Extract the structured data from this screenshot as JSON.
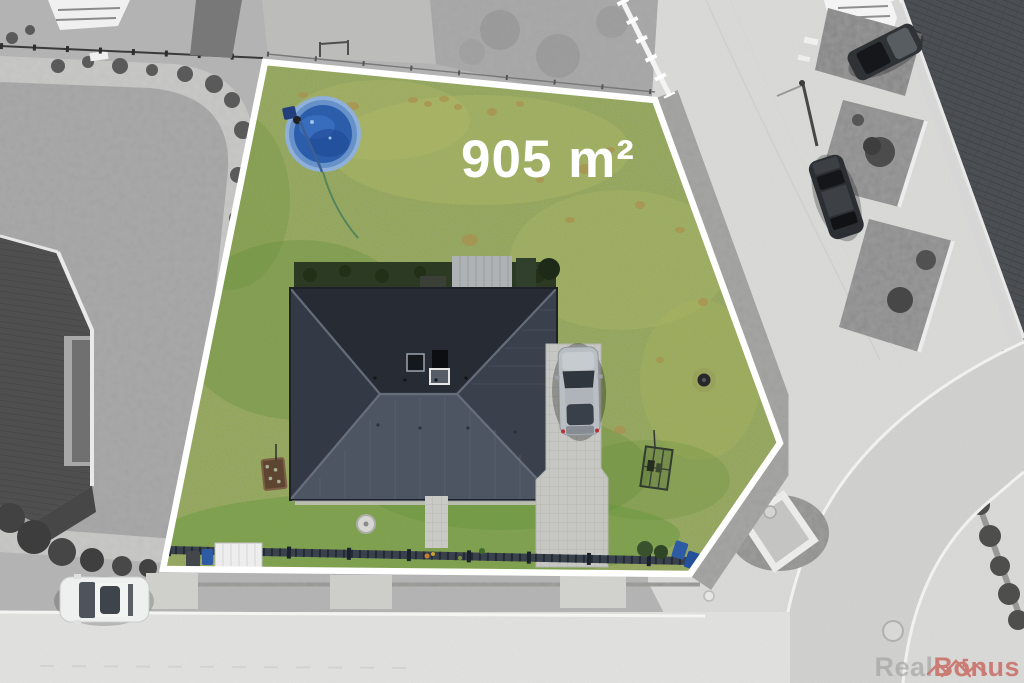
{
  "plot": {
    "area_label": "905 m²",
    "boundary_color": "#ffffff"
  },
  "watermark": {
    "brand_first": "Real",
    "brand_second": "Bonus",
    "first_color": "#9b9b9b",
    "second_color": "#c23a2e"
  },
  "colors": {
    "grass": "#8da345",
    "pool_water": "#2b5dab",
    "pool_rim": "#8fb0d8",
    "roof_north": "#272c34",
    "roof_south": "#4e5562",
    "driveway_paving": "#c6c6c2",
    "street_paving": "#dcdcda",
    "surroundings": "#b3b3b3"
  }
}
